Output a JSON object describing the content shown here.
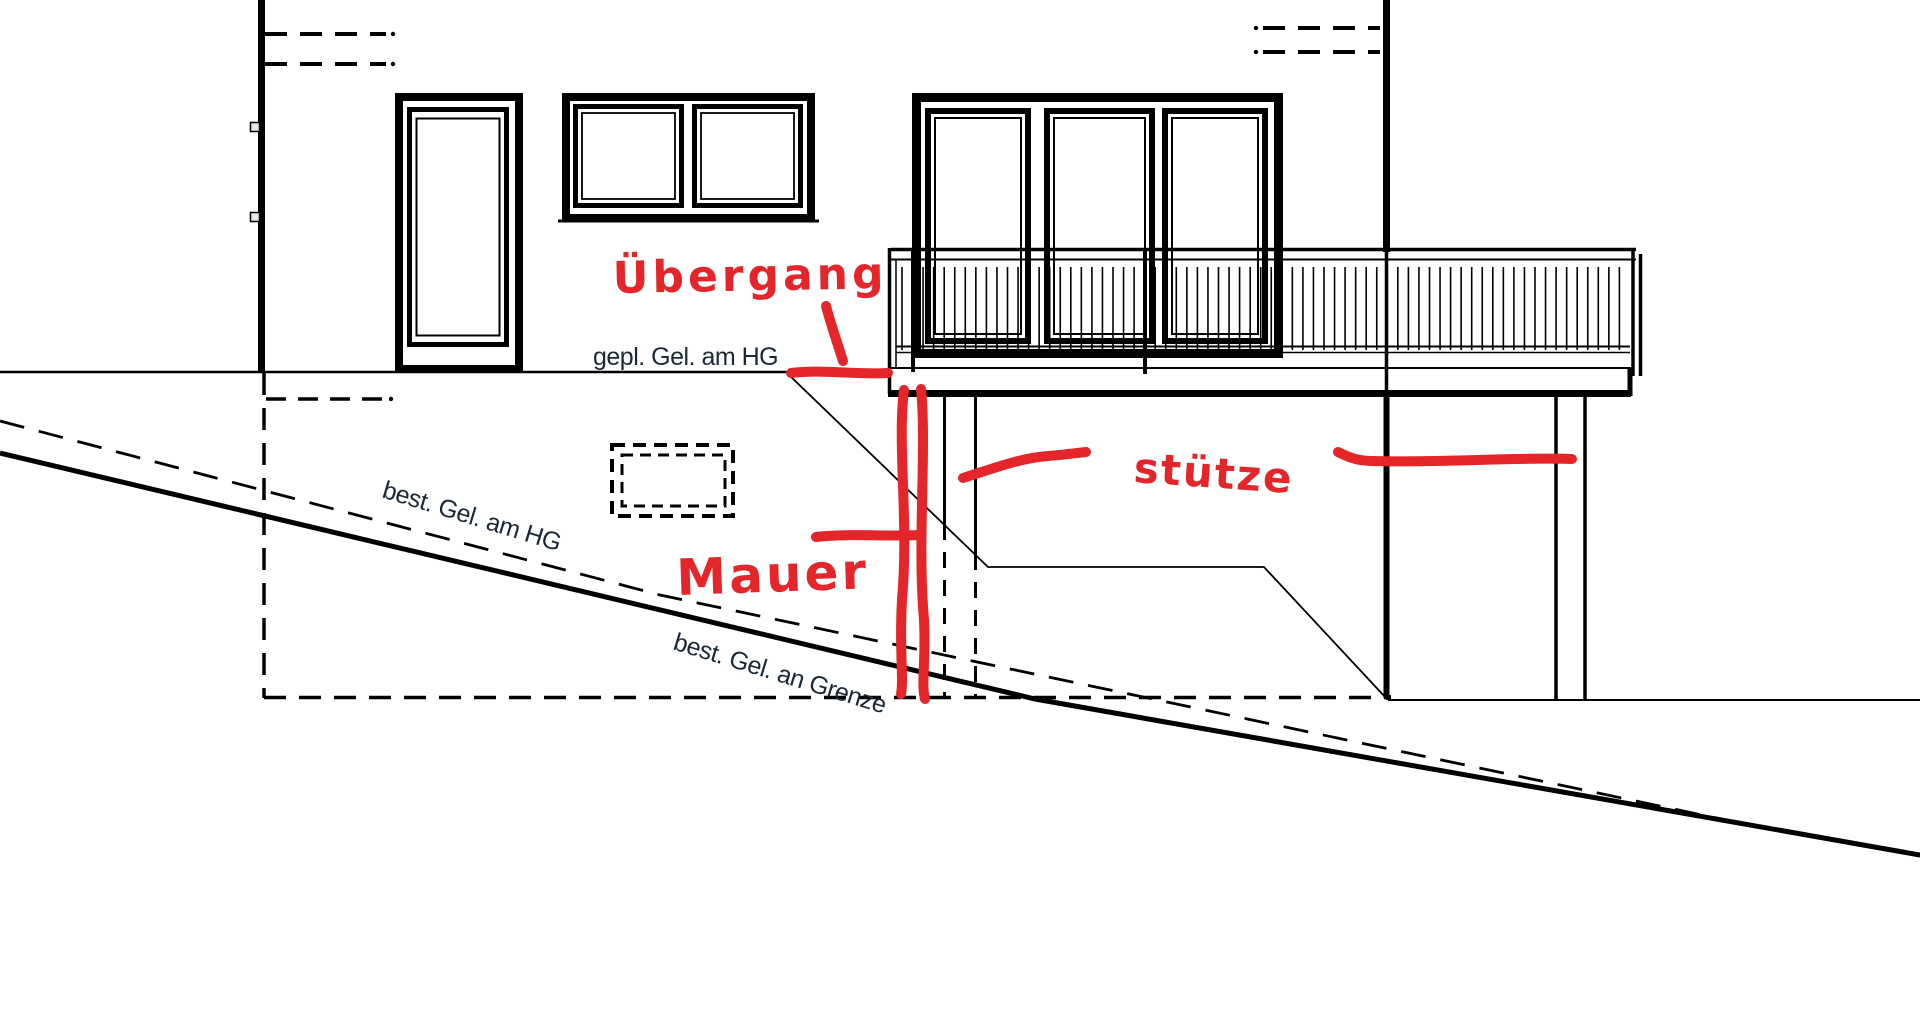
{
  "drawing": {
    "kind": "architectural elevation sketch with handwritten markup",
    "colors": {
      "paper": "#ffffff",
      "ink": "#000000",
      "label_ink": "#1b2838",
      "annotation_red": "#e42529"
    },
    "labels": {
      "planned_grade_house": "gepl. Gel. am HG",
      "existing_grade_house": "best. Gel. am HG",
      "existing_grade_boundary": "best. Gel. an Grenze"
    },
    "annotations": {
      "transition": "Übergang",
      "wall": "Mauer",
      "support": "stütze"
    }
  }
}
